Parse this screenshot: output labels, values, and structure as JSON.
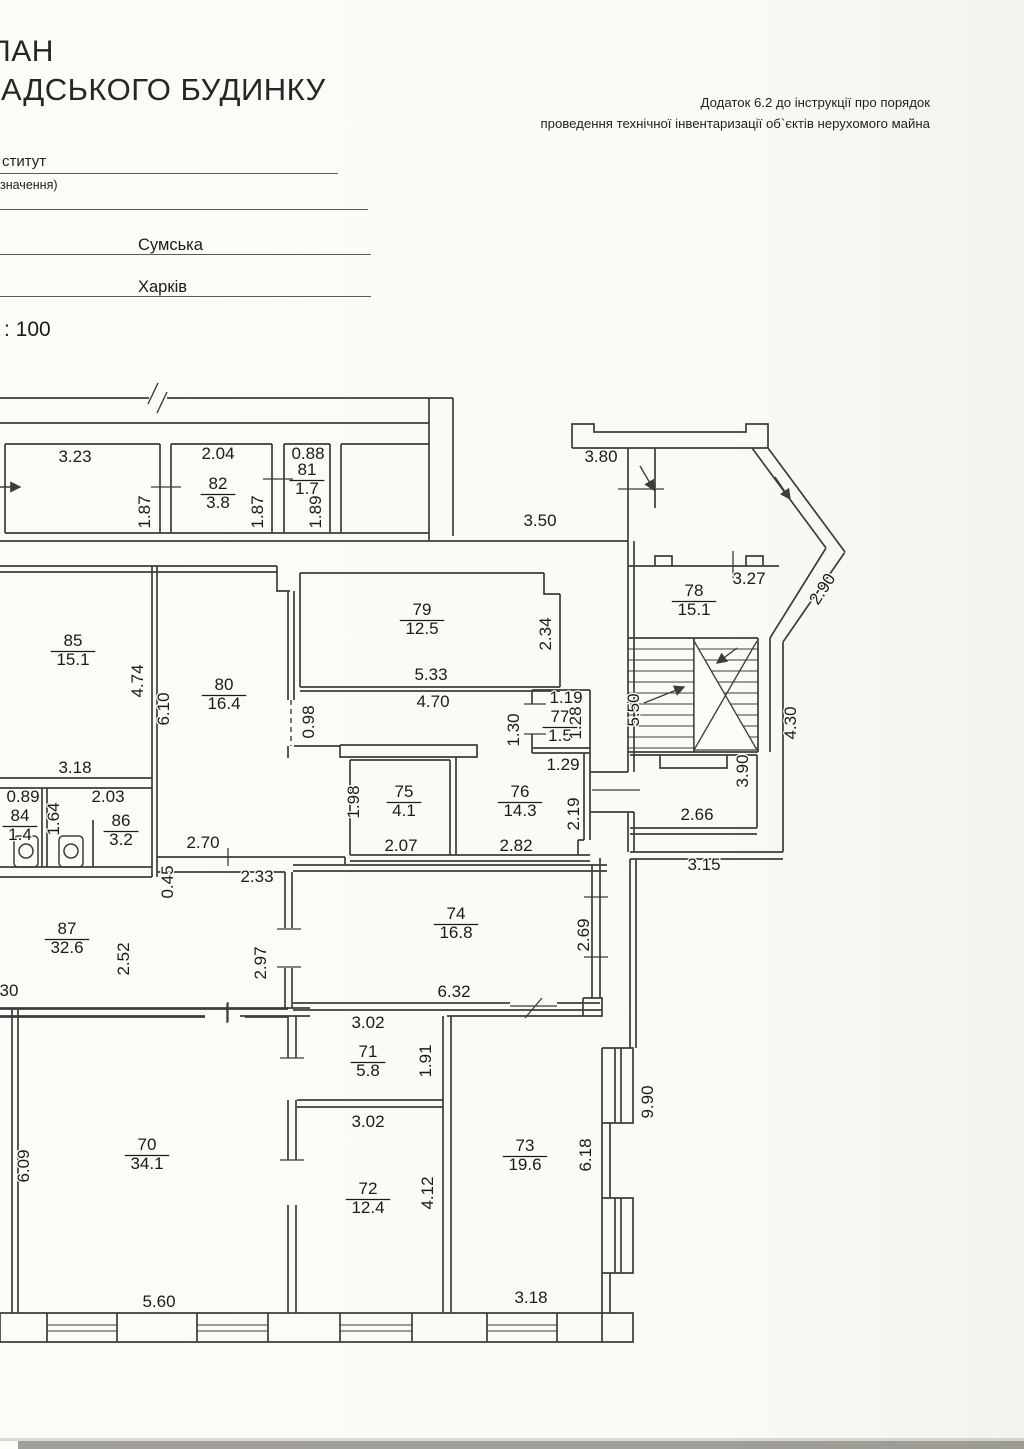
{
  "header": {
    "title_line1": "ЛАН",
    "title_line2": "АДСЬКОГО БУДИНКУ",
    "note_line1": "Додаток 6.2 до інструкції про порядок",
    "note_line2": "проведення технічної інвентаризації об`єктів нерухомого майна"
  },
  "form": {
    "institute": "ститут",
    "purpose": "значення)",
    "street": "Сумська",
    "city": "Харків",
    "scale": ": 100"
  },
  "plan": {
    "rooms": [
      {
        "num": "85",
        "area": "15.1",
        "x": 73,
        "y": 646
      },
      {
        "num": "80",
        "area": "16.4",
        "x": 224,
        "y": 690
      },
      {
        "num": "79",
        "area": "12.5",
        "x": 422,
        "y": 615
      },
      {
        "num": "82",
        "area": "3.8",
        "x": 218,
        "y": 489
      },
      {
        "num": "81",
        "area": "1.7",
        "x": 307,
        "y": 475
      },
      {
        "num": "78",
        "area": "15.1",
        "x": 694,
        "y": 596
      },
      {
        "num": "77",
        "area": "1.5",
        "x": 560,
        "y": 722
      },
      {
        "num": "76",
        "area": "14.3",
        "x": 520,
        "y": 797
      },
      {
        "num": "75",
        "area": "4.1",
        "x": 404,
        "y": 797
      },
      {
        "num": "84",
        "area": "1.4",
        "x": 20,
        "y": 821
      },
      {
        "num": "86",
        "area": "3.2",
        "x": 121,
        "y": 826
      },
      {
        "num": "87",
        "area": "32.6",
        "x": 67,
        "y": 934
      },
      {
        "num": "74",
        "area": "16.8",
        "x": 456,
        "y": 919
      },
      {
        "num": "70",
        "area": "34.1",
        "x": 147,
        "y": 1150
      },
      {
        "num": "71",
        "area": "5.8",
        "x": 368,
        "y": 1057
      },
      {
        "num": "72",
        "area": "12.4",
        "x": 368,
        "y": 1194
      },
      {
        "num": "73",
        "area": "19.6",
        "x": 525,
        "y": 1151
      }
    ],
    "dims": [
      {
        "v": "3.23",
        "x": 75,
        "y": 462
      },
      {
        "v": "2.04",
        "x": 218,
        "y": 459
      },
      {
        "v": "0.88",
        "x": 308,
        "y": 459
      },
      {
        "v": "1.87",
        "x": 150,
        "y": 512,
        "r": -90
      },
      {
        "v": "1.87",
        "x": 263,
        "y": 512,
        "r": -90
      },
      {
        "v": "1.89",
        "x": 321,
        "y": 512,
        "r": -90
      },
      {
        "v": "3.50",
        "x": 540,
        "y": 526
      },
      {
        "v": "3.80",
        "x": 601,
        "y": 462
      },
      {
        "v": "3.27",
        "x": 749,
        "y": 584
      },
      {
        "v": "2.90",
        "x": 827,
        "y": 592,
        "r": -57
      },
      {
        "v": "5.50",
        "x": 639,
        "y": 710,
        "r": -90
      },
      {
        "v": "3.90",
        "x": 748,
        "y": 771,
        "r": -90
      },
      {
        "v": "4.30",
        "x": 796,
        "y": 723,
        "r": -90
      },
      {
        "v": "2.66",
        "x": 697,
        "y": 820
      },
      {
        "v": "3.15",
        "x": 704,
        "y": 870
      },
      {
        "v": "5.33",
        "x": 431,
        "y": 680
      },
      {
        "v": "2.34",
        "x": 551,
        "y": 634,
        "r": -90
      },
      {
        "v": "4.70",
        "x": 433,
        "y": 707
      },
      {
        "v": "0.98",
        "x": 314,
        "y": 722,
        "r": -90
      },
      {
        "v": "1.19",
        "x": 566,
        "y": 703
      },
      {
        "v": "1.28",
        "x": 581,
        "y": 723,
        "r": -90
      },
      {
        "v": "1.30",
        "x": 519,
        "y": 730,
        "r": -90
      },
      {
        "v": "1.29",
        "x": 563,
        "y": 770
      },
      {
        "v": "1.98",
        "x": 359,
        "y": 802,
        "r": -90
      },
      {
        "v": "2.07",
        "x": 401,
        "y": 851
      },
      {
        "v": "2.82",
        "x": 516,
        "y": 851
      },
      {
        "v": "2.19",
        "x": 579,
        "y": 814,
        "r": -90
      },
      {
        "v": "4.74",
        "x": 143,
        "y": 681,
        "r": -90
      },
      {
        "v": "6.10",
        "x": 169,
        "y": 709,
        "r": -90
      },
      {
        "v": "3.18",
        "x": 75,
        "y": 773
      },
      {
        "v": "0.89",
        "x": 23,
        "y": 802
      },
      {
        "v": "2.03",
        "x": 108,
        "y": 802
      },
      {
        "v": "1.64",
        "x": 59,
        "y": 819,
        "r": -90
      },
      {
        "v": "2.70",
        "x": 203,
        "y": 848
      },
      {
        "v": "0.45",
        "x": 173,
        "y": 882,
        "r": -90
      },
      {
        "v": "2.33",
        "x": 257,
        "y": 882
      },
      {
        "v": "2.52",
        "x": 129,
        "y": 959,
        "r": -90
      },
      {
        "v": "2.97",
        "x": 266,
        "y": 963,
        "r": -90
      },
      {
        "v": "2.69",
        "x": 589,
        "y": 935,
        "r": -90
      },
      {
        "v": "6.32",
        "x": 454,
        "y": 997
      },
      {
        "v": "30",
        "x": 9,
        "y": 996
      },
      {
        "v": "3.02",
        "x": 368,
        "y": 1028
      },
      {
        "v": "1.91",
        "x": 431,
        "y": 1061,
        "r": -90
      },
      {
        "v": "3.02",
        "x": 368,
        "y": 1127
      },
      {
        "v": "4.12",
        "x": 433,
        "y": 1193,
        "r": -90
      },
      {
        "v": "6.09",
        "x": 29,
        "y": 1166,
        "r": -90
      },
      {
        "v": "6.18",
        "x": 591,
        "y": 1155,
        "r": -90
      },
      {
        "v": "9.90",
        "x": 653,
        "y": 1102,
        "r": -90
      },
      {
        "v": "5.60",
        "x": 159,
        "y": 1307
      },
      {
        "v": "3.18",
        "x": 531,
        "y": 1303
      }
    ]
  }
}
